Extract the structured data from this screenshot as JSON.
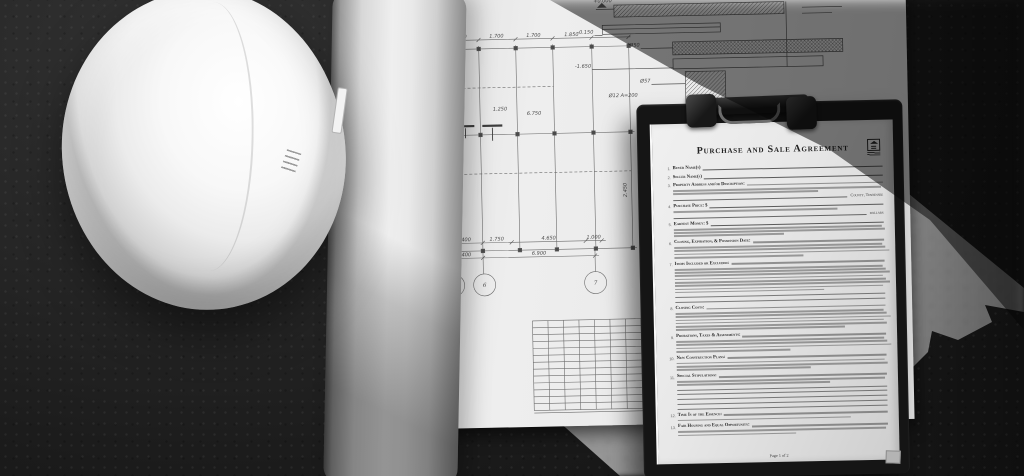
{
  "colors": {
    "background": "#1c1b1a",
    "concrete_lit": "#8e8d8b",
    "sheet_paper": "#eceae5",
    "clipboard_frame": "#151515",
    "document_paper": "#e9e7e1",
    "ink": "#22222c"
  },
  "document": {
    "title": "Purchase and Sale Agreement",
    "page_label": "Page 1 of 2",
    "clauses": [
      {
        "num": "1.",
        "label": "Buyer Name(s)",
        "fill": "rule",
        "body_lines": 0
      },
      {
        "num": "2.",
        "label": "Seller Name(s)",
        "fill": "rule",
        "body_lines": 0
      },
      {
        "num": "3.",
        "label": "Property Address and/or Description:",
        "fill": "bar",
        "body_lines": 2,
        "suffix": "County, Tennessee"
      },
      {
        "num": "4.",
        "label": "Purchase Price: $",
        "fill": "rule",
        "body_lines": 1,
        "suffix": "dollars"
      },
      {
        "num": "5.",
        "label": "Earnest Money: $",
        "fill": "rule",
        "body_lines": 3
      },
      {
        "num": "6.",
        "label": "Closing, Expiration, & Possession Date:",
        "fill": "bar",
        "body_lines": 4
      },
      {
        "num": "7.",
        "label": "Items Included or Excluded:",
        "fill": "bar",
        "body_lines": 8,
        "blank_lines": 2
      },
      {
        "num": "8.",
        "label": "Closing Costs:",
        "fill": "bar",
        "body_lines": 6
      },
      {
        "num": "9.",
        "label": "Prorations, Taxes & Assessments:",
        "fill": "bar",
        "body_lines": 4
      },
      {
        "num": "10.",
        "label": "New Construction Plans:",
        "fill": "bar",
        "body_lines": 3
      },
      {
        "num": "11.",
        "label": "Special Stipulations:",
        "fill": "bar",
        "body_lines": 2,
        "blank_lines": 5
      },
      {
        "num": "12.",
        "label": "Time Is of the Essence:",
        "fill": "bar",
        "body_lines": 1
      },
      {
        "num": "13.",
        "label": "Fair Housing and Equal Opportunity:",
        "fill": "bar",
        "body_lines": 2
      }
    ]
  },
  "blueprint": {
    "dims_top": [
      "1.700",
      "1.700",
      "1.700",
      "1.850"
    ],
    "dims_left": [
      "2.600",
      "7.500"
    ],
    "dims_right": [
      "2.450"
    ],
    "dims_mid": [
      "1.250",
      "6.750"
    ],
    "dims_bottom_row1": [
      "2.400",
      "1.750",
      "4.650",
      "1.000"
    ],
    "dims_bottom_row2": [
      "2.400",
      "6.900"
    ],
    "grid_bubbles": [
      "6",
      "7"
    ],
    "detail_labels": [
      "+0.000",
      "-0.150",
      "-1.650",
      "Ø50",
      "Ø57",
      "Ø12 A=200"
    ]
  }
}
